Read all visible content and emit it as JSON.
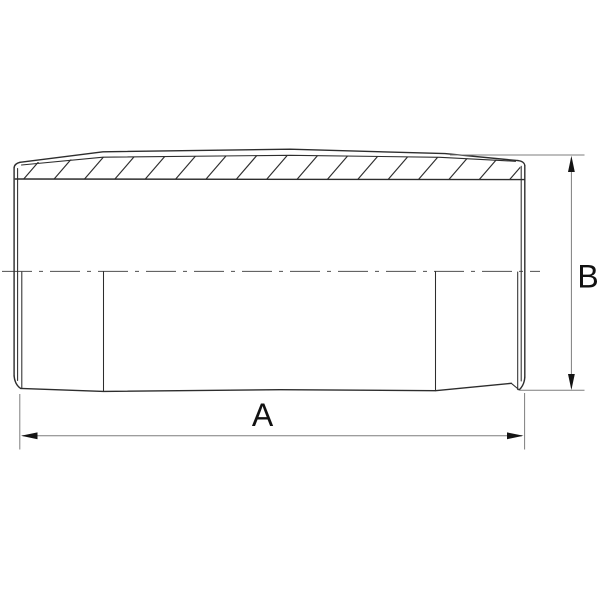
{
  "drawing": {
    "labels": {
      "width_dim": "A",
      "height_dim": "B"
    },
    "colors": {
      "outline": "#2d2d2d",
      "centerline": "#4f4f4f",
      "dimension": "#7d7d7d",
      "arrow": "#141414",
      "label": "#111111",
      "background": "#ffffff"
    },
    "hatch": {
      "count": 17,
      "start_x": 22,
      "spacing": 30.4,
      "dx": 25,
      "y_bottom": 181,
      "y_top": 152
    }
  }
}
